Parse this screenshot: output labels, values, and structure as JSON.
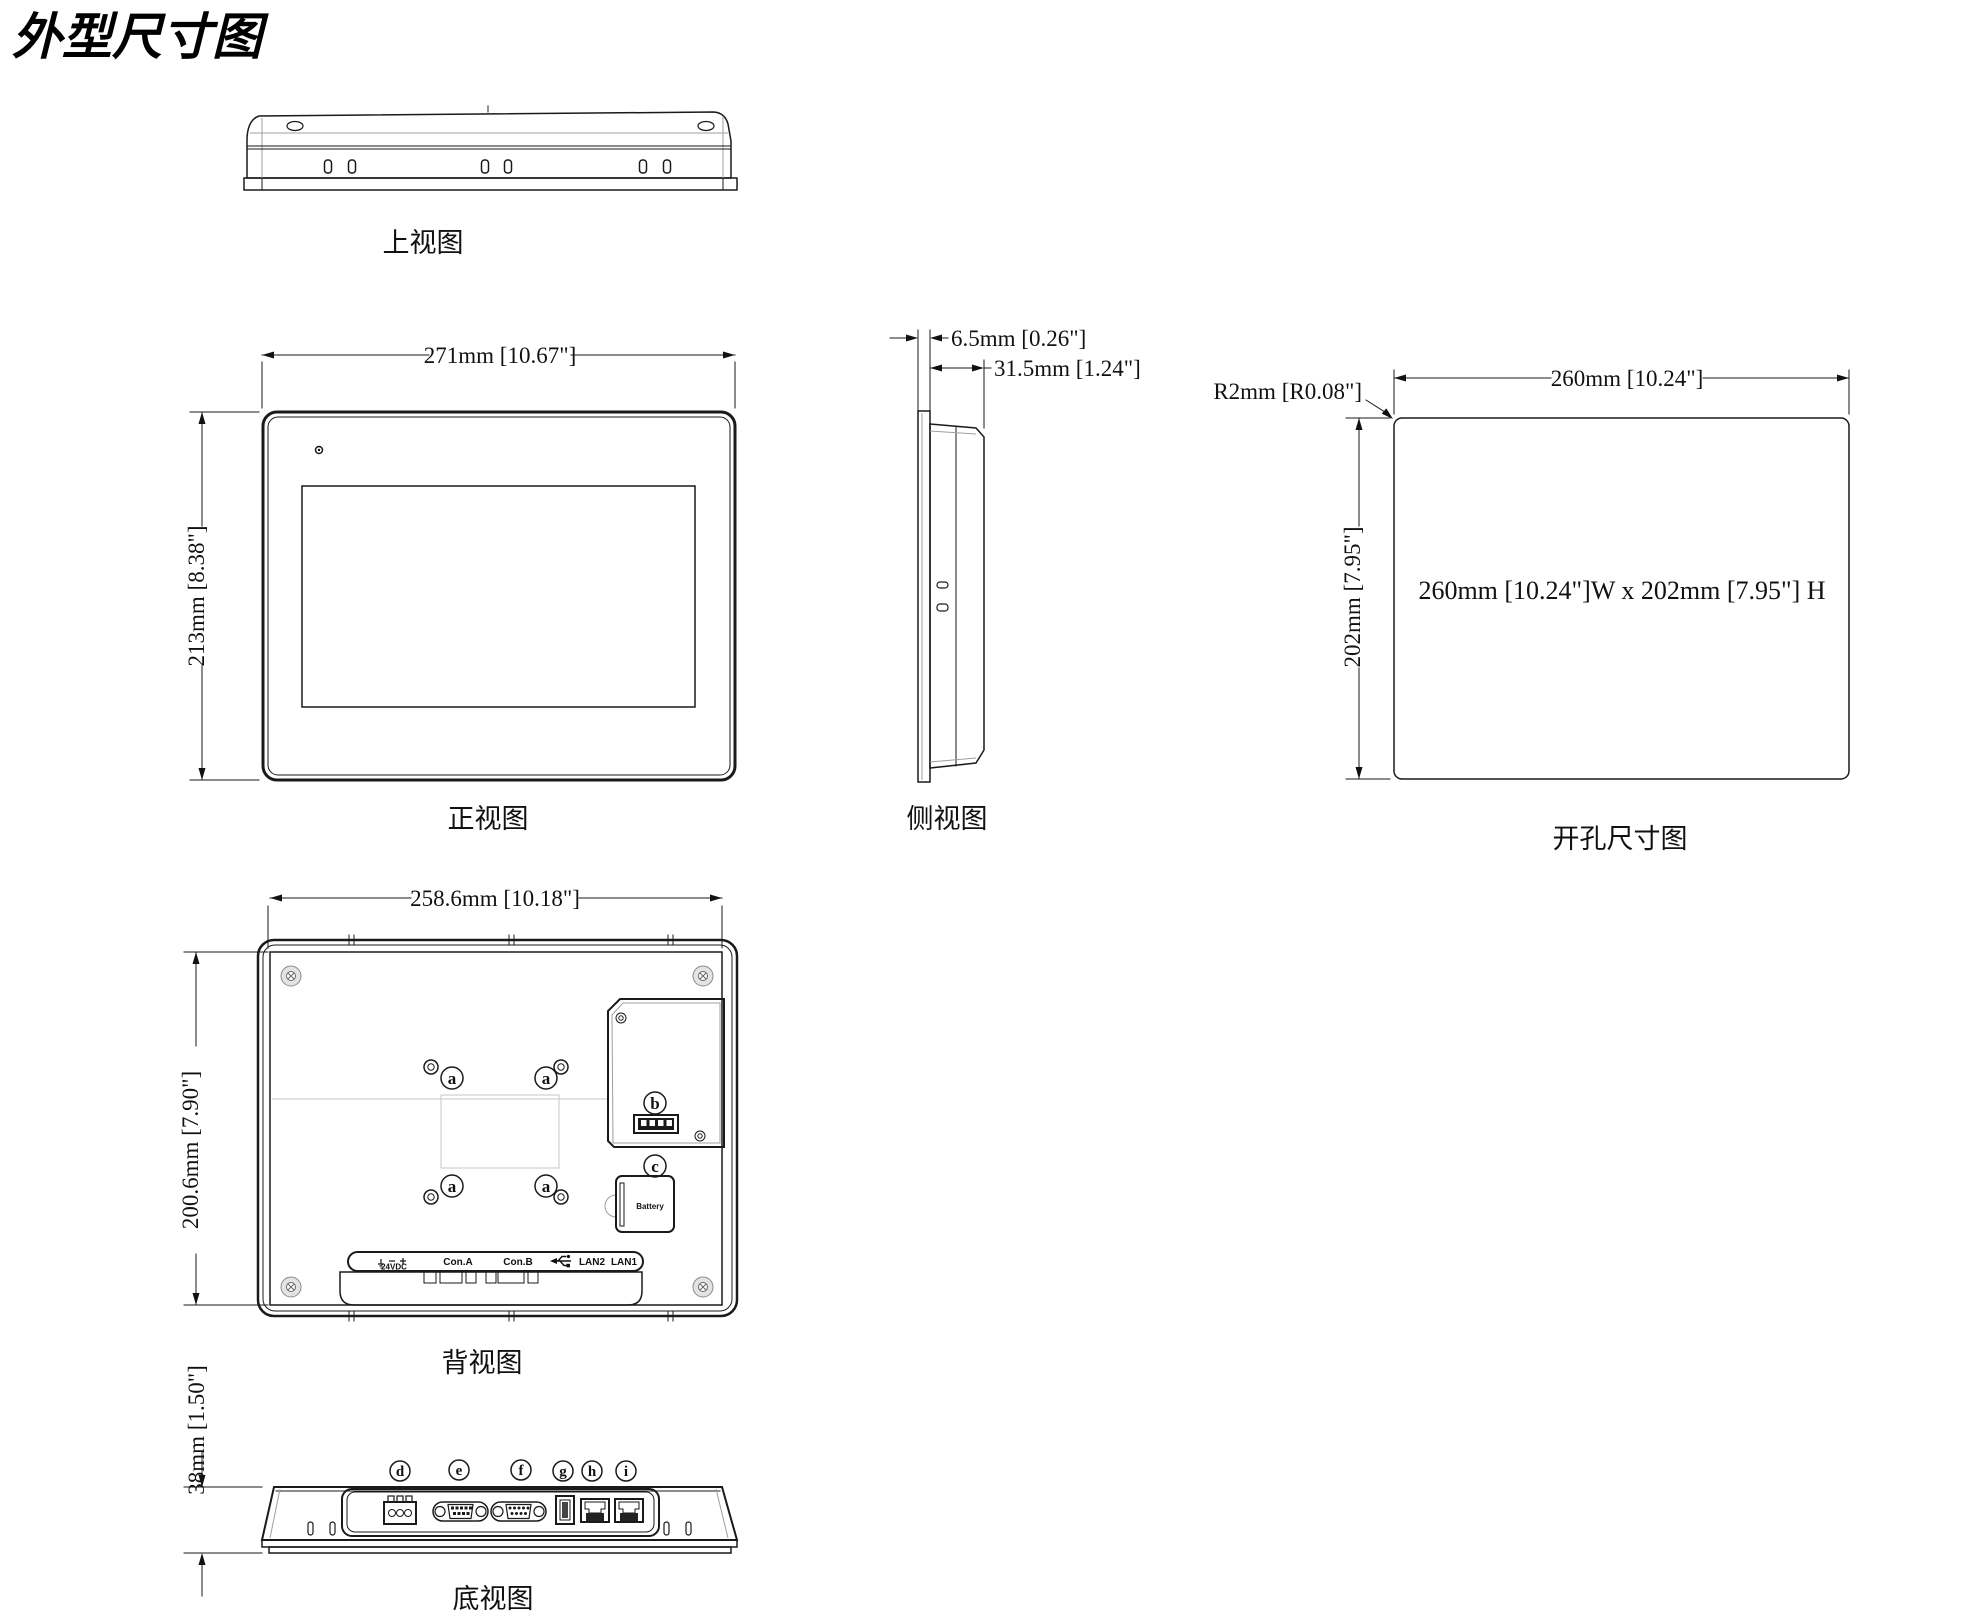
{
  "title": "外型尺寸图",
  "views": {
    "top": {
      "label": "上视图"
    },
    "front": {
      "label": "正视图",
      "width_dim": "271mm [10.67\"]",
      "height_dim": "213mm [8.38\"]"
    },
    "side": {
      "label": "侧视图",
      "bezel_dim": "6.5mm [0.26\"]",
      "depth_dim": "31.5mm [1.24\"]"
    },
    "cutout": {
      "label": "开孔尺寸图",
      "width_dim": "260mm [10.24\"]",
      "height_dim": "202mm [7.95\"]",
      "corner_radius_dim": "R2mm [R0.08\"]",
      "note": "260mm [10.24\"]W x 202mm [7.95\"] H"
    },
    "rear": {
      "label": "背视图",
      "width_dim": "258.6mm [10.18\"]",
      "height_dim": "200.6mm [7.90\"]",
      "battery_label": "Battery",
      "ports": {
        "power_value": "24VDC",
        "con_a": "Con.A",
        "con_b": "Con.B",
        "lan2": "LAN2",
        "lan1": "LAN1"
      }
    },
    "bottom": {
      "label": "底视图",
      "height_dim": "38mm [1.50\"]"
    }
  },
  "callouts": {
    "vesa_hole": "a",
    "dip_switch": "b",
    "battery": "c",
    "power_connector": "d",
    "com_port_a": "e",
    "com_port_b": "f",
    "usb_port": "g",
    "lan_port_2": "h",
    "lan_port_1": "i"
  },
  "colors": {
    "line": "#1a1a1a",
    "light_line": "#9aa0a6",
    "background": "#ffffff"
  }
}
